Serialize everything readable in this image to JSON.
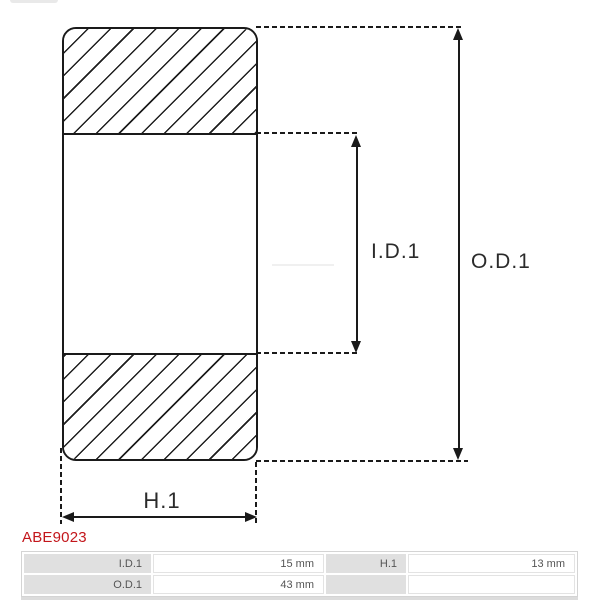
{
  "diagram": {
    "inner_diameter_label": "I.D.1",
    "outer_diameter_label": "O.D.1",
    "height_label": "H.1"
  },
  "part_number": "ABE9023",
  "colors": {
    "line_black": "#1a1a1a",
    "accent_red": "#c3161b",
    "table_label_bg": "#e0e0e0"
  },
  "spec_table": {
    "rows": [
      {
        "c0": "I.D.1",
        "c1": "15 mm",
        "c2": "H.1",
        "c3": "13 mm"
      },
      {
        "c0": "O.D.1",
        "c1": "43 mm",
        "c2": "",
        "c3": ""
      }
    ]
  }
}
